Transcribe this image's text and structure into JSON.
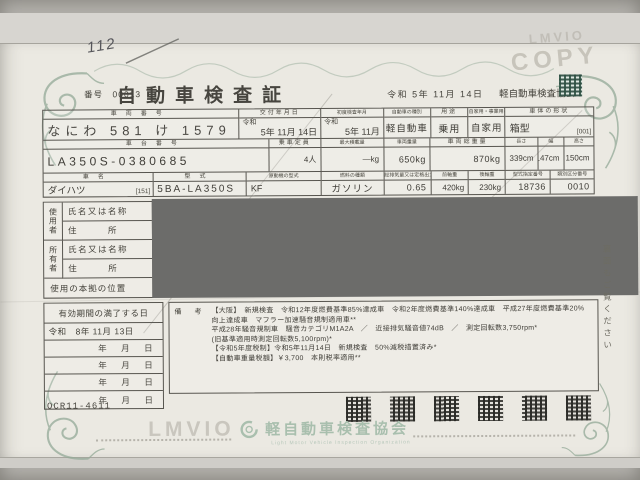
{
  "colors": {
    "paper": "#ebe9e2",
    "table_line": "#57554f",
    "redaction": "#6c6c6a",
    "ornament_teal": "#94aa98",
    "logo_green": "#a9bfae",
    "stamp_teal": "#3e6152"
  },
  "doc": {
    "number_label": "番号",
    "number": "00013",
    "handwritten_note": "112",
    "title": "自動車検査証",
    "header_date": "令和 5年 11月 14日",
    "header_issuer": "軽自動車検査協会",
    "copy_mark": "COPY",
    "watermark": "LMVIO",
    "side_note": "裏面もご覧ください",
    "form_code": "OCR11-4611"
  },
  "fields": {
    "plate": {
      "label": "車両番号",
      "value": "なにわ 581 け 1579"
    },
    "issue": {
      "label": "交付年月日",
      "era": "令和",
      "value": "5年 11月 14日"
    },
    "first_inspection": {
      "label": "初度検査年月",
      "era": "令和",
      "value": "5年 11月"
    },
    "category": {
      "label": "自動車の種別",
      "value": "軽自動車"
    },
    "use": {
      "label": "用途",
      "value": "乗用"
    },
    "ownership": {
      "label": "自家用・事業用の別",
      "value": "自家用"
    },
    "body_shape": {
      "label": "車体の形状",
      "value": "箱型",
      "code": "[001]"
    },
    "chassis": {
      "label": "車台番号",
      "value": "LA350S-0380685"
    },
    "capacity": {
      "label": "乗車定員",
      "value": "4人"
    },
    "max_load": {
      "label": "最大積載量",
      "value": "―kg"
    },
    "weight": {
      "label": "車両重量",
      "value": "650kg"
    },
    "gross_weight": {
      "label": "車両総重量",
      "value": "870kg"
    },
    "length": {
      "label": "長さ",
      "value": "339cm"
    },
    "width": {
      "label": "幅",
      "value": "147cm"
    },
    "height": {
      "label": "高さ",
      "value": "150cm"
    },
    "make": {
      "label": "車名",
      "value": "ダイハツ",
      "code": "[151]"
    },
    "model": {
      "label": "型式",
      "value": "5BA-LA350S"
    },
    "engine": {
      "label": "原動機の型式",
      "value": "KF"
    },
    "fuel": {
      "label": "燃料の種類",
      "value": "ガソリン"
    },
    "displacement": {
      "label": "総排気量又は定格出力",
      "value": "0.65"
    },
    "front_axle": {
      "label": "前軸重",
      "value": "420kg"
    },
    "rear_axle": {
      "label": "後軸重",
      "value": "230kg"
    },
    "type_designation": {
      "label": "型式指定番号",
      "value": "18736"
    },
    "class_number": {
      "label": "類別区分番号",
      "value": "0010"
    }
  },
  "parties": {
    "user_label": "使用者",
    "owner_label": "所有者",
    "name_label": "氏名又は名称",
    "address_label": "住　　　所",
    "base_label": "使用の本拠の位置"
  },
  "validity": {
    "label": "有効期間の満了する日",
    "expiry": "令和　8年 11月 13日",
    "blank": "年　月　日"
  },
  "remarks": {
    "label": "備　考",
    "lines": [
      "【大阪】　新規検査　令和12年度燃費基準85%達成車　令和2年度燃費基準140%達成車　平成27年度燃費基準20%",
      "向上達成車　マフラー加速騒音規制適用車**",
      "平成28年騒音規制車　騒音カテゴリM1A2A　／　近接排気騒音値74dB　／　測定回転数3,750rpm*",
      "(旧基準適用時測定回転数5,100rpm)*",
      "【令和5年度税制】令和5年11月14日　新規検査　50%減税措置済み*",
      "【自動車重量税額】￥3,700　本則税率適用**"
    ]
  },
  "footer": {
    "org_name": "軽自動車検査協会",
    "org_name_en": "Light Motor Vehicle Inspection Organization"
  }
}
